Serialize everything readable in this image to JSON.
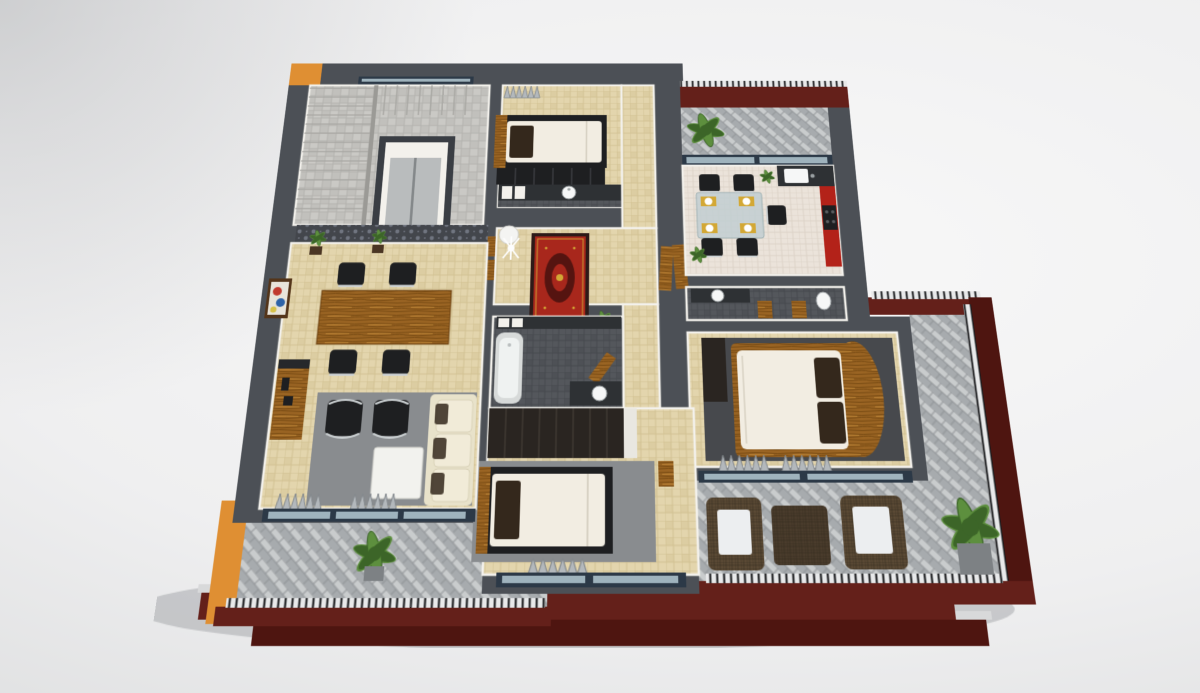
{
  "scene": {
    "type": "3d-floor-plan-cutaway-render",
    "view": "isometric-top-down",
    "storeys": "upper floor interior shown above maroon lower-storey facade with balconies",
    "rooms": [
      {
        "name": "stair-lobby",
        "floor": "stone-tile",
        "items": [
          "staircase-l-shaped",
          "elevator-shaft",
          "window-north"
        ]
      },
      {
        "name": "bedroom-north",
        "floor": "beige-tile",
        "items": [
          "single-bed",
          "wood-headboard",
          "dark-bench",
          "gray-curtains"
        ]
      },
      {
        "name": "vanity-strip",
        "floor": "dark-tile",
        "items": [
          "counter",
          "round-sink",
          "wall-cabinets"
        ]
      },
      {
        "name": "hallway",
        "floor": "beige-tile",
        "items": [
          "red-oriental-rug",
          "white-round-table",
          "coat-stand",
          "white-bench",
          "open-wood-doors",
          "plant"
        ]
      },
      {
        "name": "kitchen-dining",
        "floor": "light-tile",
        "items": [
          "glass-table",
          "black-chairs-5",
          "gold-placemats-4",
          "red-tall-cabinets",
          "dark-counter",
          "sink",
          "stove",
          "plant"
        ]
      },
      {
        "name": "balcony-north",
        "floor": "herringbone-pavers",
        "items": [
          "fern",
          "maroon-parapet",
          "railing",
          "sliding-glass-door"
        ]
      },
      {
        "name": "bathroom-central",
        "floor": "dark-tile",
        "items": [
          "bathtub",
          "cistern-boxes",
          "wood-door",
          "counter-sink"
        ]
      },
      {
        "name": "bathroom-east",
        "floor": "dark-tile",
        "items": [
          "counter-sink",
          "toilet",
          "wood-doors-2"
        ]
      },
      {
        "name": "bedroom-master",
        "floor": "beige-tile",
        "items": [
          "double-bed-curved-wood-frame",
          "brown-pillows-2",
          "charcoal-rug",
          "dark-wardrobe",
          "gray-curtains",
          "south-window"
        ]
      },
      {
        "name": "balcony-east",
        "floor": "herringbone-pavers",
        "items": [
          "maroon-parapet",
          "railing"
        ]
      },
      {
        "name": "wardrobe-block",
        "floor": "-",
        "items": [
          "dark-wood-wardrobe"
        ]
      },
      {
        "name": "bedroom-south",
        "floor": "beige-tile",
        "items": [
          "single-bed",
          "gray-rug",
          "gray-curtains",
          "south-window",
          "wood-door"
        ]
      },
      {
        "name": "dining-room",
        "floor": "beige-tile",
        "items": [
          "damask-accent-wall",
          "wood-slat-panels",
          "plants-2",
          "framed-painting",
          "wood-dining-table",
          "black-chairs-4",
          "sideboard"
        ]
      },
      {
        "name": "living-room",
        "floor": "beige-tile",
        "items": [
          "gray-rug",
          "black-lounge-chairs-2",
          "white-coffee-table",
          "cream-sofa",
          "brown-pillows",
          "media-sideboard",
          "gray-curtains",
          "sliding-door"
        ]
      },
      {
        "name": "balcony-southwest",
        "floor": "herringbone-pavers",
        "items": [
          "fern",
          "orange-column",
          "maroon-parapet",
          "railing"
        ]
      },
      {
        "name": "terrace-southeast",
        "floor": "herringbone-pavers",
        "items": [
          "wicker-armchair-2",
          "wicker-ottoman",
          "fern-in-planter",
          "maroon-parapet",
          "railing"
        ]
      },
      {
        "name": "lower-storey",
        "items": [
          "maroon-facade-band-upper",
          "maroon-facade-band-lower",
          "balcony-railings",
          "concrete-ledges"
        ]
      }
    ]
  },
  "palette": {
    "bg-center": "#f8f8f8",
    "bg-mid": "#efeff0",
    "bg-edge": "#dcddde",
    "wall": "#4c5056",
    "wall-dark": "#3a3e44",
    "white-wall": "#f3f1ec",
    "plaster": "#f3f1ec",
    "floor-beige": "#e3d5ad",
    "floor-beige-grout": "#d2c193",
    "floor-beige-alt": "#dccda2",
    "floor-stone": "#cac9c5",
    "floor-stone-grout": "#b3b2ae",
    "floor-stone-alt": "#c1c0bc",
    "floor-kitchen": "#ebe3da",
    "floor-kitchen-grout": "#dbd2c7",
    "tile-dark": "#54575c",
    "tile-dark-grout": "#45484d",
    "tile-dark-alt": "#4e5156",
    "herr-light": "#c9cccd",
    "herr-dark": "#a7abae",
    "herr-line": "#8d9194",
    "damask-base": "#43464c",
    "damask-motif": "#707580",
    "maroon": "#64201a",
    "maroon-dark": "#4e1510",
    "orange": "#df8f33",
    "kitchen-red": "#b32219",
    "wood": "#9a6423",
    "wood-grain": "#774a12",
    "wood-light": "#bb8335",
    "wood-dark": "#2a2521",
    "furn-black": "#1e1f21",
    "chrome": "#cdd2d4",
    "steel": "#b9bcbd",
    "counter": "#2e3134",
    "mattress": "#f2ede2",
    "pillow-brown": "#34281c",
    "sofa-cream": "#e8e2ca",
    "sofa-cream-light": "#f1ebd8",
    "rug-gray": "#898c8f",
    "rug-charcoal": "#47494d",
    "rug-red": "#a8271c",
    "rug-red-dark": "#551410",
    "rug-border": "#2e1a18",
    "gold": "#d3a835",
    "wicker": "#5b4a35",
    "wicker-dark": "#4a3c2c",
    "cushion-white": "#eceef0",
    "glass": "#c2cfd2",
    "window-pane": "#9fb3bd",
    "window-frame": "#2c3947",
    "plant": "#5d8f3e",
    "plant-dark": "#3c6528",
    "pot": "#7d8184",
    "curtain": "#b3b8bc",
    "curtain-dark": "#84898d",
    "railing-light": "#e8e9ea",
    "railing-dark": "#17181a",
    "concrete": "#d8d9da",
    "shadow": "#8e9296"
  }
}
